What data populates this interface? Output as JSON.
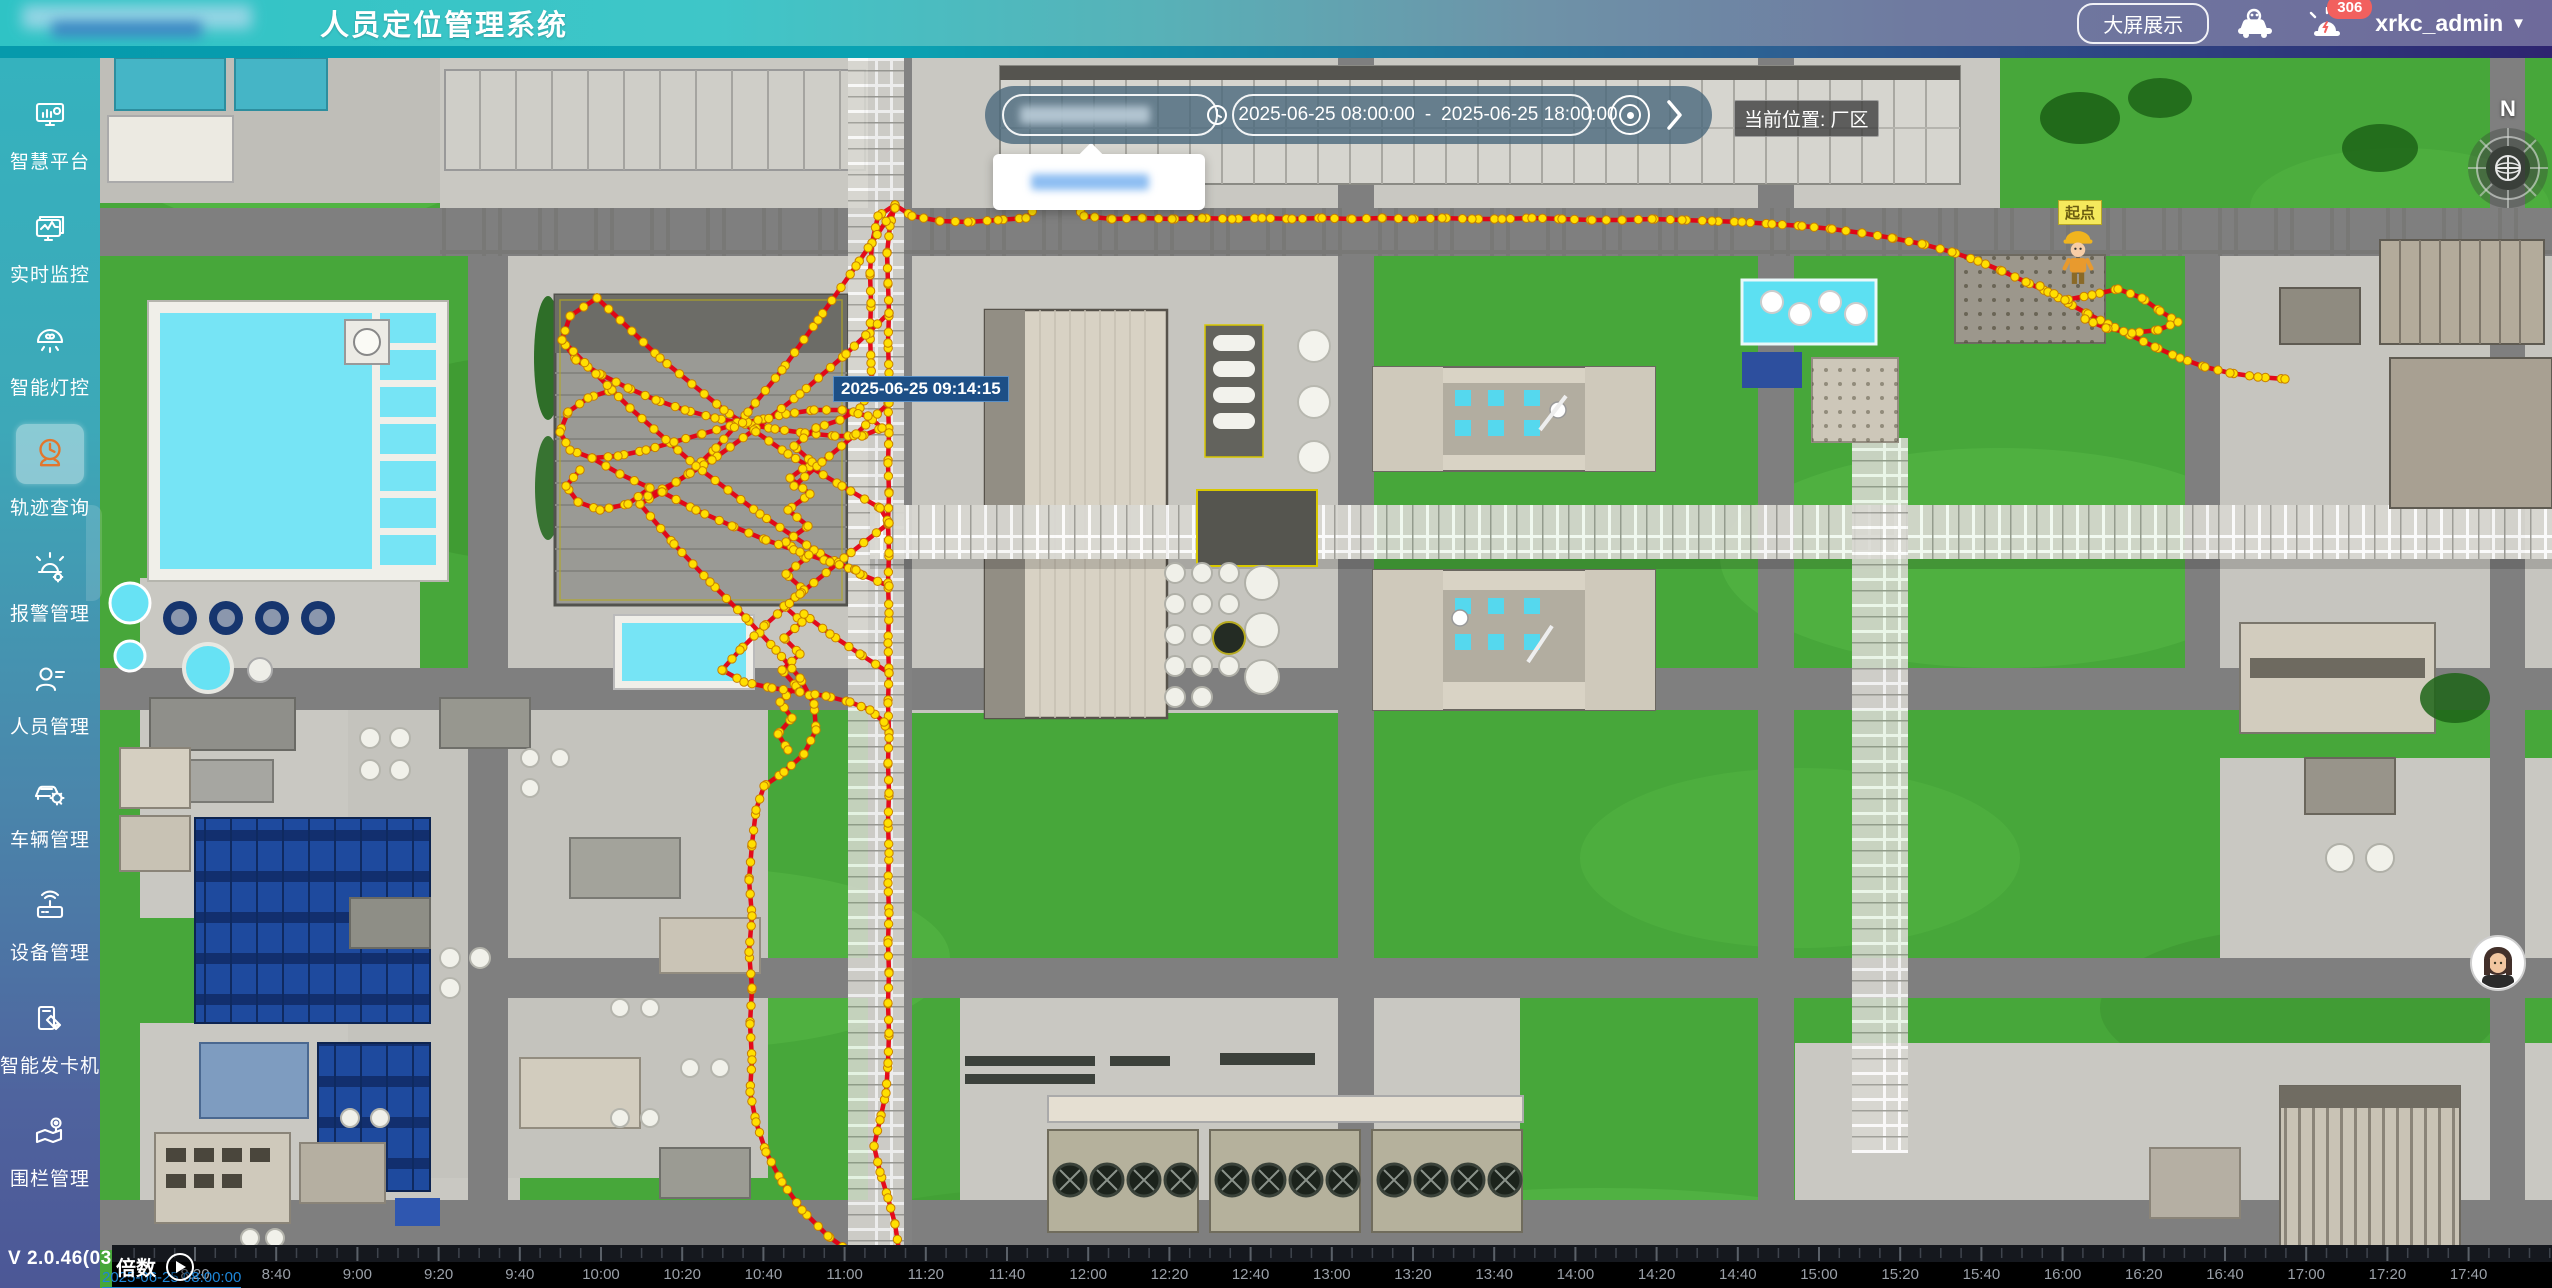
{
  "header": {
    "title": "人员定位管理系统",
    "big_screen_button": "大屏展示",
    "alarm_count": "306",
    "username": "xrkc_admin"
  },
  "sidebar": {
    "items": [
      {
        "label": "智慧平台",
        "icon": "smart-platform-icon",
        "active": false
      },
      {
        "label": "实时监控",
        "icon": "realtime-monitor-icon",
        "active": false
      },
      {
        "label": "智能灯控",
        "icon": "smart-light-icon",
        "active": false
      },
      {
        "label": "轨迹查询",
        "icon": "track-query-icon",
        "active": true
      },
      {
        "label": "报警管理",
        "icon": "alarm-manage-icon",
        "active": false
      },
      {
        "label": "人员管理",
        "icon": "person-manage-icon",
        "active": false
      },
      {
        "label": "车辆管理",
        "icon": "vehicle-manage-icon",
        "active": false
      },
      {
        "label": "设备管理",
        "icon": "device-manage-icon",
        "active": false
      },
      {
        "label": "智能发卡机",
        "icon": "card-dispenser-icon",
        "active": false
      },
      {
        "label": "围栏管理",
        "icon": "fence-manage-icon",
        "active": false
      }
    ],
    "version": "V 2.0.46(0313)"
  },
  "toolbar": {
    "search_value": "",
    "date_start": "2025-06-25 08:00:00",
    "date_separator": "-",
    "date_end": "2025-06-25 18:00:00",
    "location_label": "当前位置: 厂区"
  },
  "map": {
    "tooltip": "2025-06-25 09:14:15",
    "start_label": "起点",
    "compass_label": "N"
  },
  "timeline": {
    "multiplier_label": "倍数",
    "current_time": "2025-06-25 08:00:00",
    "ticks": [
      "8:20",
      "8:40",
      "9:00",
      "9:20",
      "9:40",
      "10:00",
      "10:20",
      "10:40",
      "11:00",
      "11:20",
      "11:40",
      "12:00",
      "12:20",
      "12:40",
      "13:00",
      "13:20",
      "13:40",
      "14:00",
      "14:20",
      "14:40",
      "15:00",
      "15:20",
      "15:40",
      "16:00",
      "16:20",
      "16:40",
      "17:00",
      "17:20",
      "17:40"
    ]
  },
  "colors": {
    "track_red": "#e60012",
    "dot_yellow": "#ffdf00",
    "dot_edge": "#c77f00",
    "sidebar_active_icon": "#e2762d",
    "alarm_badge": "#f2605e",
    "playhead_blue": "#1d86d8"
  },
  "track_dot_spacing": 16,
  "tracks": [
    [
      [
        795,
        147
      ],
      [
        812,
        158
      ],
      [
        840,
        163
      ],
      [
        868,
        164
      ],
      [
        898,
        162
      ],
      [
        926,
        160
      ],
      [
        945,
        140
      ],
      [
        956,
        122
      ],
      [
        968,
        140
      ],
      [
        984,
        158
      ],
      [
        1012,
        161
      ],
      [
        1042,
        160
      ],
      [
        1072,
        161
      ],
      [
        1102,
        160
      ],
      [
        1132,
        161
      ],
      [
        1162,
        160
      ],
      [
        1192,
        161
      ],
      [
        1222,
        160
      ],
      [
        1252,
        161
      ],
      [
        1282,
        160
      ],
      [
        1312,
        161
      ],
      [
        1342,
        160
      ],
      [
        1372,
        161
      ],
      [
        1402,
        161
      ],
      [
        1432,
        160
      ],
      [
        1462,
        161
      ],
      [
        1492,
        162
      ],
      [
        1522,
        162
      ],
      [
        1552,
        161
      ],
      [
        1582,
        162
      ],
      [
        1612,
        163
      ],
      [
        1642,
        164
      ],
      [
        1672,
        166
      ],
      [
        1702,
        168
      ],
      [
        1732,
        171
      ],
      [
        1762,
        175
      ],
      [
        1792,
        180
      ],
      [
        1822,
        186
      ],
      [
        1852,
        194
      ],
      [
        1878,
        203
      ],
      [
        1902,
        213
      ],
      [
        1926,
        224
      ],
      [
        1948,
        234
      ],
      [
        1968,
        245
      ],
      [
        1988,
        256
      ],
      [
        2008,
        266
      ],
      [
        2030,
        277
      ],
      [
        2055,
        289
      ],
      [
        2080,
        300
      ],
      [
        2105,
        309
      ],
      [
        2130,
        315
      ],
      [
        2158,
        319
      ],
      [
        2185,
        321
      ]
    ],
    [
      [
        1940,
        228
      ],
      [
        1965,
        242
      ],
      [
        1992,
        237
      ],
      [
        2018,
        231
      ],
      [
        2042,
        240
      ],
      [
        2060,
        253
      ],
      [
        2078,
        264
      ],
      [
        2058,
        272
      ],
      [
        2032,
        275
      ],
      [
        2006,
        270
      ],
      [
        1985,
        261
      ]
    ],
    [
      [
        795,
        147
      ],
      [
        790,
        168
      ],
      [
        787,
        195
      ],
      [
        788,
        225
      ],
      [
        789,
        255
      ],
      [
        788,
        285
      ],
      [
        789,
        315
      ],
      [
        788,
        345
      ],
      [
        789,
        375
      ],
      [
        788,
        405
      ],
      [
        789,
        435
      ],
      [
        788,
        465
      ],
      [
        789,
        495
      ],
      [
        788,
        525
      ],
      [
        789,
        555
      ],
      [
        788,
        585
      ],
      [
        789,
        615
      ],
      [
        788,
        645
      ],
      [
        789,
        675
      ],
      [
        788,
        705
      ],
      [
        789,
        735
      ],
      [
        788,
        765
      ],
      [
        789,
        795
      ],
      [
        788,
        825
      ],
      [
        789,
        855
      ],
      [
        788,
        885
      ],
      [
        789,
        915
      ],
      [
        788,
        945
      ],
      [
        789,
        975
      ],
      [
        788,
        1005
      ],
      [
        786,
        1035
      ],
      [
        780,
        1062
      ],
      [
        774,
        1088
      ],
      [
        780,
        1114
      ],
      [
        788,
        1140
      ],
      [
        795,
        1166
      ],
      [
        799,
        1192
      ],
      [
        797,
        1215
      ],
      [
        795,
        1230
      ]
    ],
    [
      [
        795,
        147
      ],
      [
        778,
        158
      ],
      [
        772,
        185
      ],
      [
        770,
        215
      ],
      [
        771,
        245
      ],
      [
        770,
        275
      ],
      [
        771,
        305
      ],
      [
        772,
        330
      ],
      [
        760,
        350
      ],
      [
        740,
        362
      ],
      [
        716,
        370
      ]
    ],
    [
      [
        497,
        240
      ],
      [
        470,
        258
      ],
      [
        462,
        282
      ],
      [
        476,
        302
      ],
      [
        500,
        316
      ],
      [
        528,
        330
      ],
      [
        556,
        342
      ],
      [
        585,
        352
      ],
      [
        615,
        360
      ],
      [
        645,
        366
      ],
      [
        675,
        371
      ],
      [
        705,
        375
      ],
      [
        735,
        378
      ],
      [
        762,
        378
      ],
      [
        782,
        370
      ],
      [
        768,
        358
      ],
      [
        742,
        352
      ],
      [
        714,
        352
      ],
      [
        686,
        356
      ],
      [
        658,
        362
      ],
      [
        630,
        368
      ],
      [
        602,
        376
      ],
      [
        574,
        384
      ],
      [
        546,
        392
      ],
      [
        518,
        398
      ],
      [
        492,
        400
      ],
      [
        470,
        392
      ],
      [
        460,
        374
      ],
      [
        468,
        354
      ],
      [
        488,
        340
      ],
      [
        512,
        332
      ]
    ],
    [
      [
        795,
        150
      ],
      [
        756,
        208
      ],
      [
        718,
        262
      ],
      [
        682,
        312
      ],
      [
        648,
        354
      ],
      [
        616,
        390
      ],
      [
        588,
        416
      ],
      [
        562,
        434
      ],
      [
        540,
        446
      ]
    ],
    [
      [
        789,
        255
      ],
      [
        746,
        296
      ],
      [
        700,
        336
      ],
      [
        654,
        372
      ],
      [
        612,
        402
      ],
      [
        576,
        424
      ],
      [
        548,
        438
      ]
    ],
    [
      [
        497,
        240
      ],
      [
        560,
        300
      ],
      [
        624,
        352
      ],
      [
        688,
        396
      ],
      [
        742,
        428
      ],
      [
        780,
        450
      ],
      [
        789,
        465
      ]
    ],
    [
      [
        462,
        282
      ],
      [
        530,
        350
      ],
      [
        596,
        408
      ],
      [
        660,
        456
      ],
      [
        714,
        492
      ],
      [
        760,
        516
      ],
      [
        789,
        528
      ]
    ],
    [
      [
        716,
        370
      ],
      [
        694,
        388
      ],
      [
        712,
        404
      ],
      [
        690,
        420
      ],
      [
        710,
        436
      ],
      [
        688,
        452
      ],
      [
        708,
        468
      ],
      [
        686,
        484
      ],
      [
        706,
        500
      ],
      [
        686,
        516
      ],
      [
        704,
        532
      ],
      [
        684,
        548
      ],
      [
        702,
        564
      ],
      [
        684,
        580
      ],
      [
        700,
        596
      ],
      [
        682,
        612
      ],
      [
        696,
        628
      ],
      [
        680,
        644
      ],
      [
        692,
        660
      ],
      [
        678,
        676
      ],
      [
        688,
        692
      ]
    ],
    [
      [
        540,
        446
      ],
      [
        574,
        486
      ],
      [
        610,
        524
      ],
      [
        646,
        560
      ],
      [
        676,
        592
      ],
      [
        700,
        620
      ],
      [
        714,
        646
      ],
      [
        716,
        672
      ],
      [
        704,
        696
      ],
      [
        684,
        714
      ],
      [
        664,
        728
      ],
      [
        656,
        752
      ],
      [
        652,
        786
      ],
      [
        649,
        822
      ],
      [
        652,
        858
      ],
      [
        649,
        894
      ],
      [
        652,
        930
      ],
      [
        650,
        966
      ],
      [
        652,
        1002
      ],
      [
        650,
        1034
      ],
      [
        656,
        1064
      ],
      [
        666,
        1094
      ],
      [
        682,
        1124
      ],
      [
        702,
        1152
      ],
      [
        728,
        1178
      ],
      [
        758,
        1200
      ],
      [
        786,
        1218
      ],
      [
        797,
        1228
      ]
    ],
    [
      [
        789,
        465
      ],
      [
        744,
        500
      ],
      [
        700,
        536
      ],
      [
        664,
        568
      ],
      [
        640,
        592
      ],
      [
        622,
        612
      ],
      [
        644,
        624
      ],
      [
        672,
        630
      ],
      [
        700,
        634
      ],
      [
        726,
        638
      ],
      [
        750,
        644
      ],
      [
        770,
        652
      ],
      [
        784,
        664
      ],
      [
        789,
        680
      ]
    ],
    [
      [
        562,
        434
      ],
      [
        596,
        452
      ],
      [
        632,
        468
      ],
      [
        666,
        482
      ],
      [
        700,
        494
      ],
      [
        730,
        504
      ],
      [
        756,
        512
      ]
    ],
    [
      [
        492,
        400
      ],
      [
        520,
        416
      ],
      [
        550,
        430
      ],
      [
        528,
        446
      ],
      [
        500,
        452
      ],
      [
        478,
        444
      ],
      [
        466,
        428
      ],
      [
        480,
        412
      ]
    ],
    [
      [
        789,
        345
      ],
      [
        756,
        376
      ],
      [
        722,
        404
      ],
      [
        694,
        428
      ]
    ],
    [
      [
        789,
        615
      ],
      [
        760,
        596
      ],
      [
        730,
        576
      ],
      [
        704,
        556
      ]
    ]
  ]
}
